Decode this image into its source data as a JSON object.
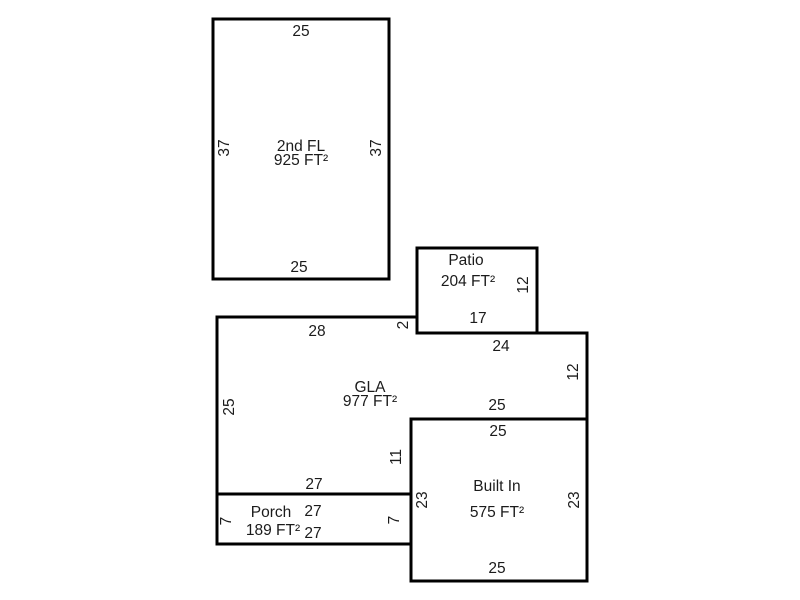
{
  "page": {
    "background": "#ffffff",
    "line_color": "#000000",
    "text_color": "#1b1b1b"
  },
  "rooms": {
    "second_floor": {
      "name": "2nd FL",
      "area": "925 FT²",
      "dim_top": "25",
      "dim_bottom": "25",
      "dim_left": "37",
      "dim_right": "37"
    },
    "patio": {
      "name": "Patio",
      "area": "204 FT²",
      "dim_bottom": "17",
      "dim_right": "12"
    },
    "gla": {
      "name": "GLA",
      "area": "977 FT²",
      "dim_top": "28",
      "dim_step_right": "2",
      "dim_upper_right": "24",
      "dim_right": "12",
      "dim_above_built_in": "25",
      "dim_left": "25",
      "dim_bottom": "27",
      "dim_inner_right": "11"
    },
    "built_in": {
      "name": "Built In",
      "area": "575 FT²",
      "dim_top": "25",
      "dim_bottom": "25",
      "dim_left": "23",
      "dim_right": "23"
    },
    "porch": {
      "name": "Porch",
      "area": "189 FT²",
      "dim_top": "27",
      "dim_bottom": "27",
      "dim_left": "7",
      "dim_right": "7"
    }
  }
}
